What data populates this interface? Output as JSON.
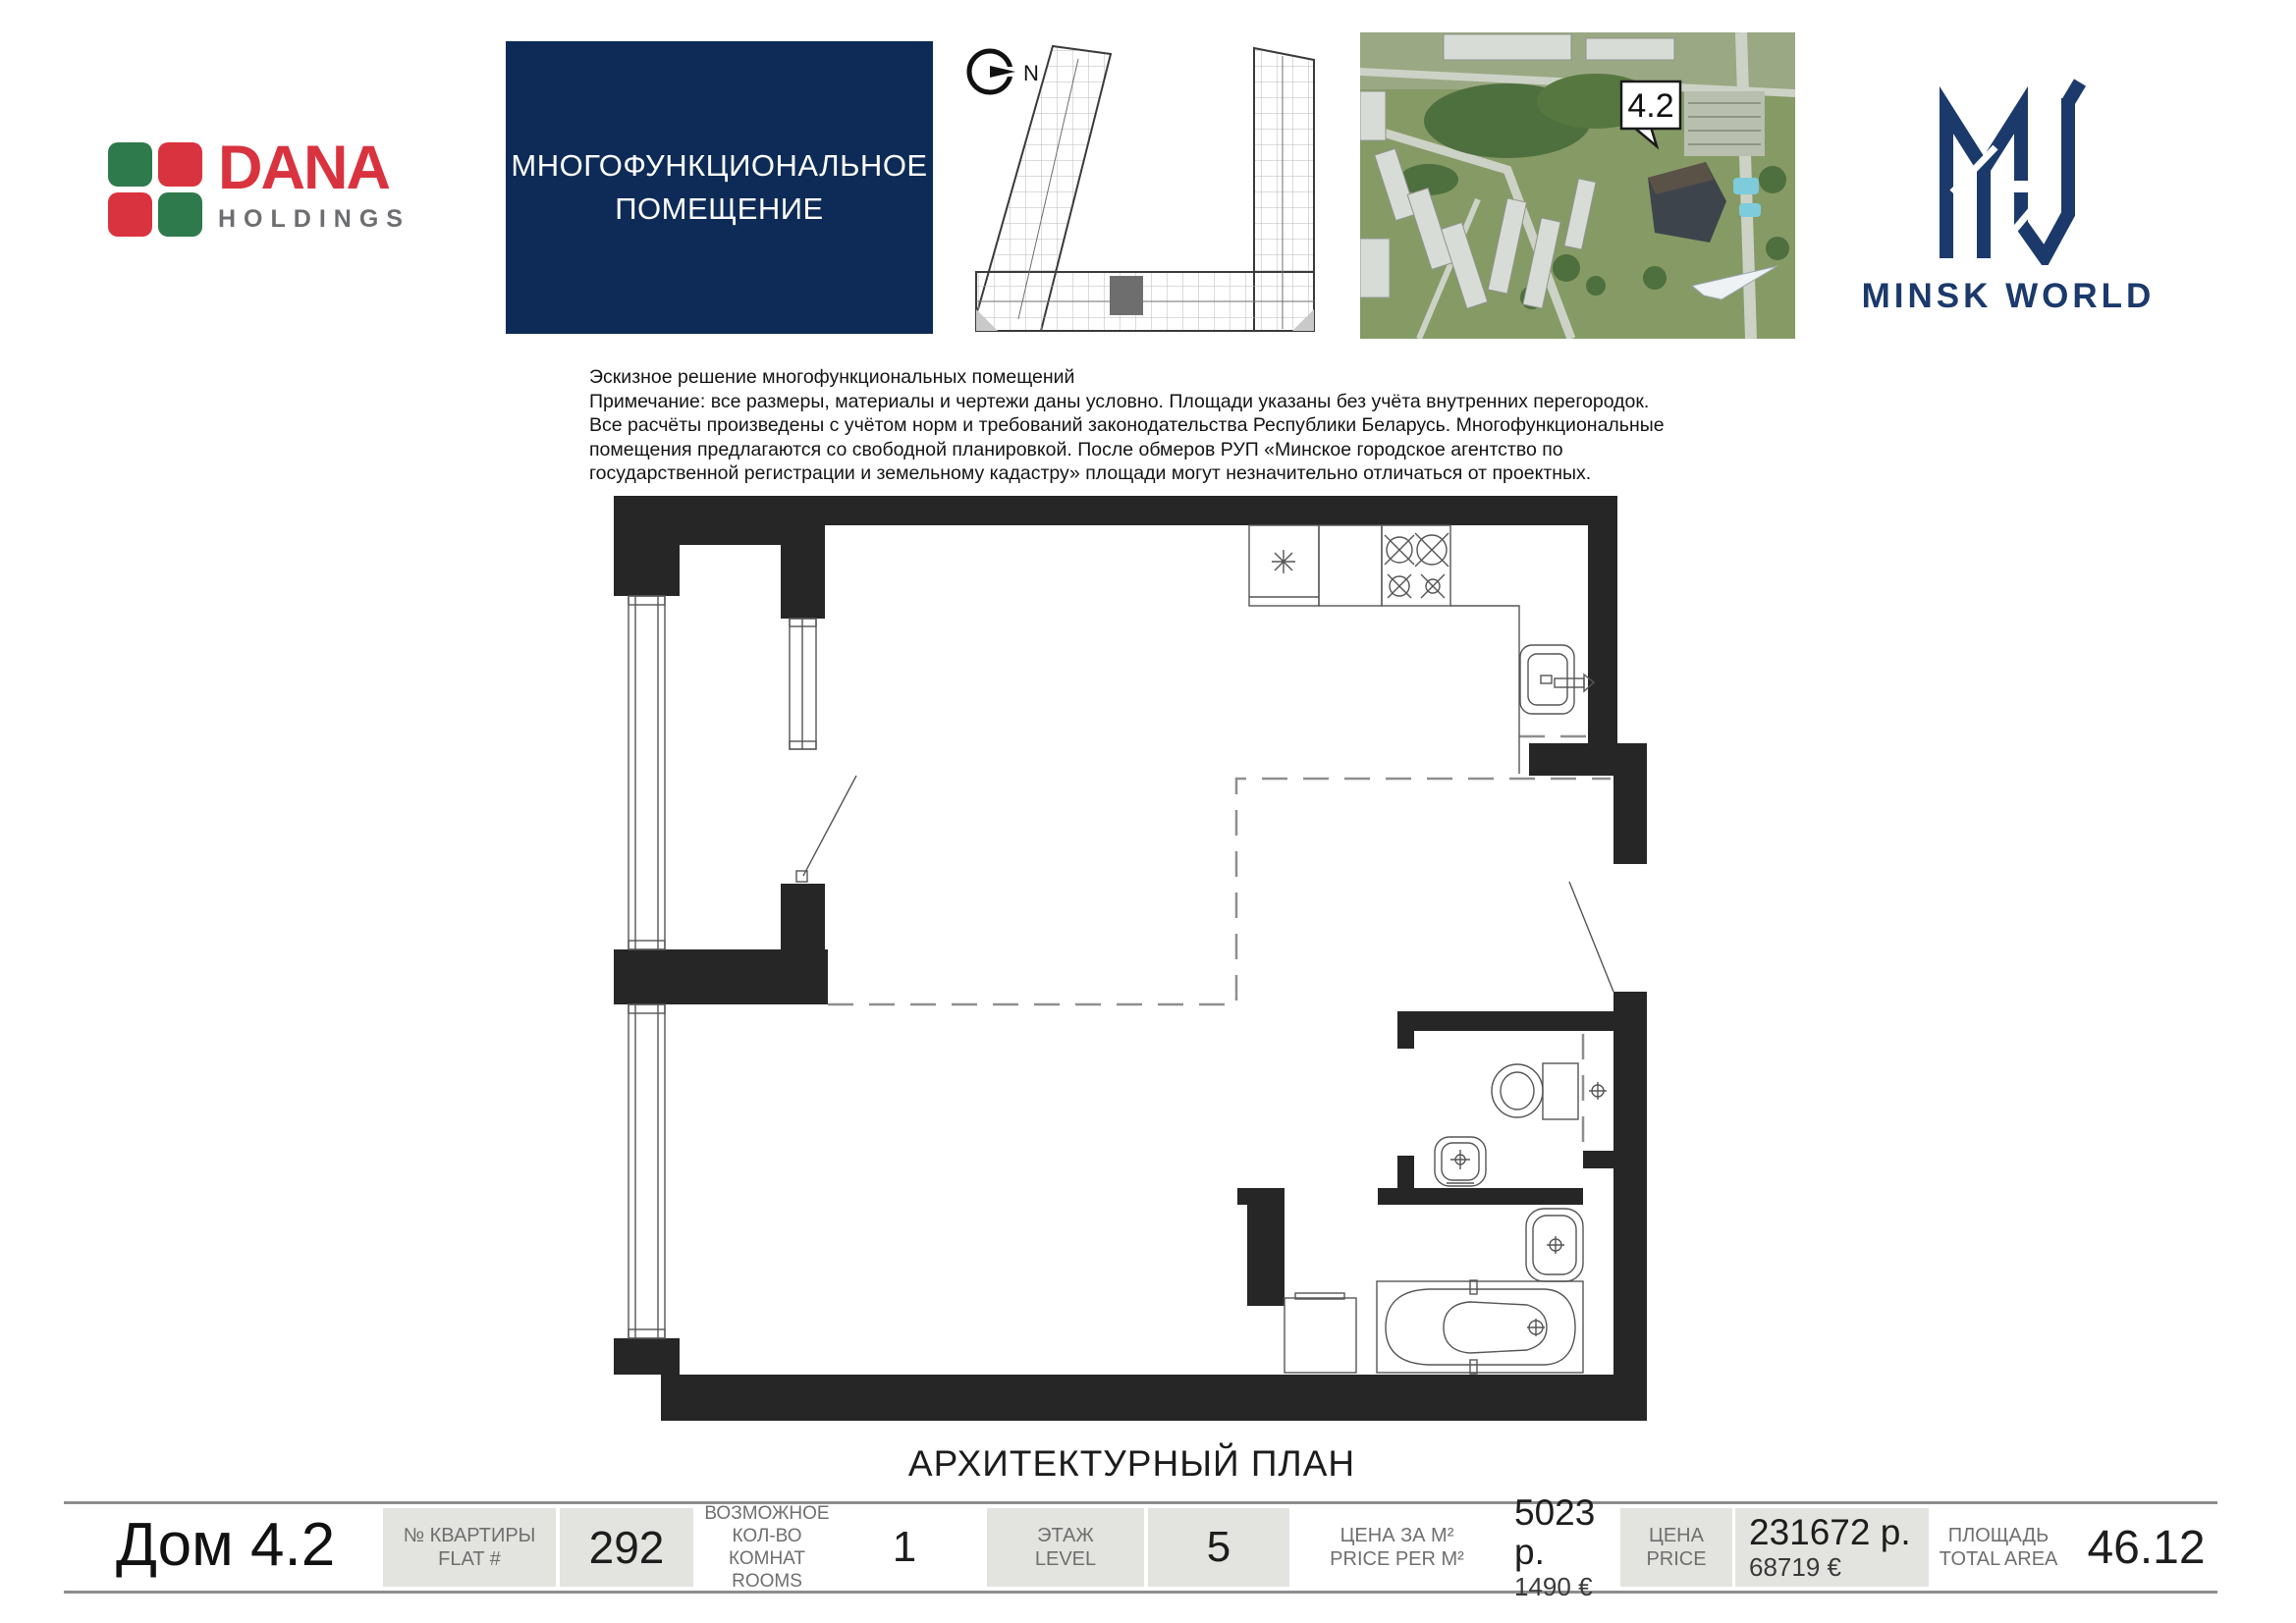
{
  "header": {
    "dana": {
      "name": "DANA",
      "holdings": "HOLDINGS"
    },
    "type_box": {
      "line1": "МНОГОФУНКЦИОНАЛЬНОЕ",
      "line2": "ПОМЕЩЕНИЕ"
    },
    "site_plan": {
      "north": "N"
    },
    "aerial": {
      "building_label": "4.2"
    },
    "minsk_world": {
      "brand": "MINSK WORLD"
    }
  },
  "note": {
    "line1": "Эскизное решение многофункциональных помещений",
    "line2": "Примечание: все размеры, материалы и чертежи даны условно. Площади указаны без учёта внутренних перегородок.",
    "line3": "Все расчёты произведены с учётом норм и требований законодательства Республики Беларусь. Многофункциональные",
    "line4": "помещения предлагаются со свободной планировкой. После обмеров РУП «Минское городское агентство по",
    "line5": "государственной регистрации и земельному кадастру» площади могут незначительно отличаться от проектных."
  },
  "plan": {
    "caption": "АРХИТЕКТУРНЫЙ ПЛАН"
  },
  "footer": {
    "house": "Дом 4.2",
    "flat": {
      "l1": "№ КВАРТИРЫ",
      "l2": "FLAT #",
      "value": "292"
    },
    "rooms": {
      "l1": "ВОЗМОЖНОЕ",
      "l2": "КОЛ-ВО КОМНАТ",
      "l3": "ROOMS",
      "value": "1"
    },
    "level": {
      "l1": "ЭТАЖ",
      "l2": "LEVEL",
      "value": "5"
    },
    "price_m2": {
      "l1": "ЦЕНА ЗА М²",
      "l2": "PRICE PER M²",
      "value": "5023 р.",
      "value2": "1490 €"
    },
    "price": {
      "l1": "ЦЕНА",
      "l2": "PRICE",
      "value": "231672 р.",
      "value2": "68719 €"
    },
    "area": {
      "l1": "ПЛОЩАДЬ",
      "l2": "TOTAL AREA",
      "value": "46.12"
    }
  },
  "colors": {
    "navy_box": "#0d2b56",
    "brand_navy": "#1b3a6b",
    "dana_red": "#d9333f",
    "dana_green": "#2f7a4c",
    "gray_cell": "#e3e3df"
  }
}
